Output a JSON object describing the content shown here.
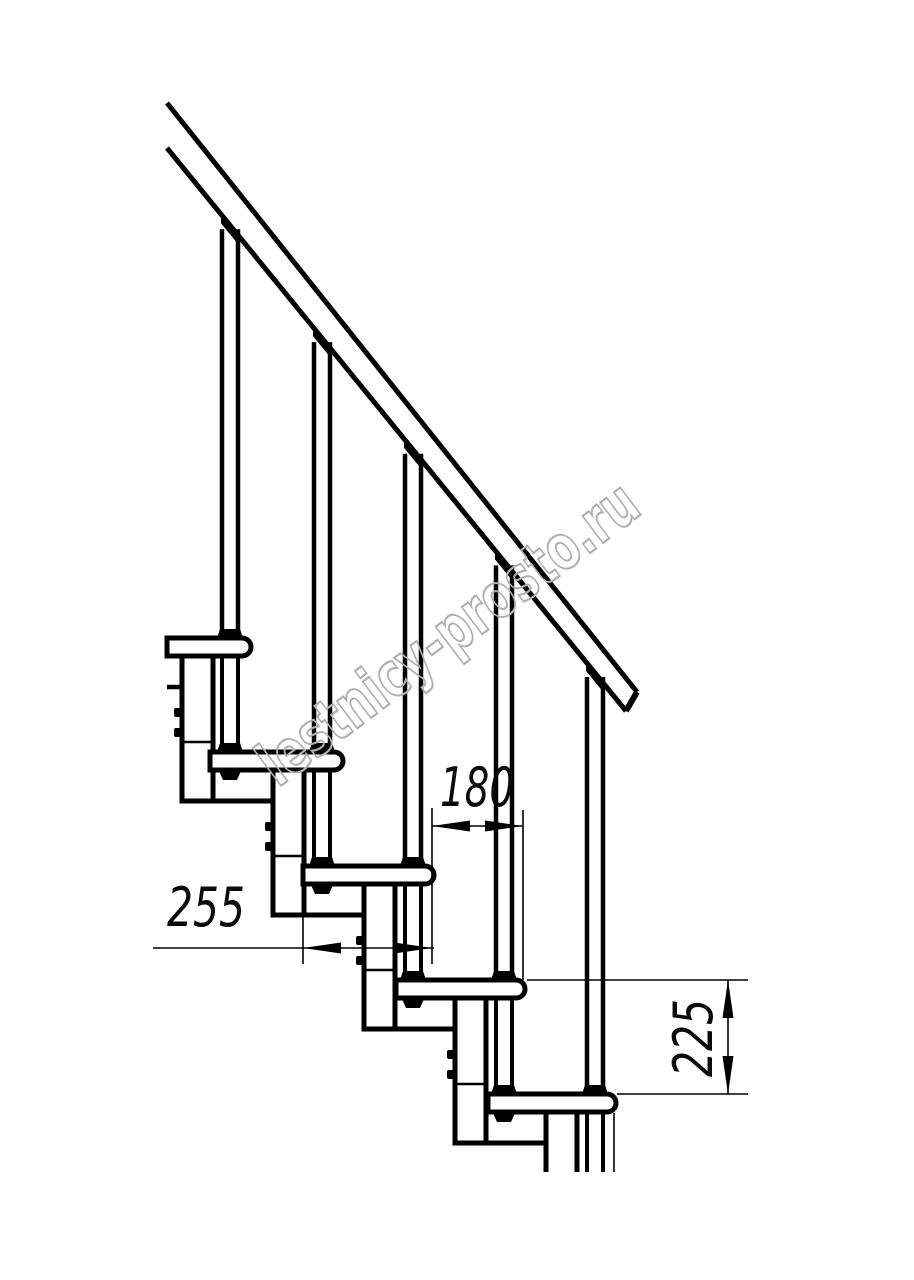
{
  "drawing": {
    "kind": "modular-staircase-side-view",
    "watermark": "lestnicy-prosto.ru",
    "line_color": "#000000",
    "background_color": "#ffffff",
    "watermark_color": "#b0b0b0",
    "dimensions": [
      {
        "id": "tread-depth",
        "value": "255"
      },
      {
        "id": "step-going",
        "value": "180"
      },
      {
        "id": "step-rise",
        "value": "225"
      }
    ]
  },
  "geometry": {
    "canvas": {
      "width": 914,
      "height": 1280
    },
    "rail": {
      "top_start": [
        167,
        103
      ],
      "top_end": [
        637,
        692
      ],
      "bottom_start": [
        167,
        148
      ],
      "bottom_end": [
        626,
        711
      ]
    },
    "steps": {
      "tread_tops": [
        638,
        752,
        866,
        980,
        1094
      ],
      "tread_backs": [
        167,
        210,
        303,
        396,
        488
      ],
      "tread_fronts": [
        251,
        343,
        434,
        525,
        616
      ],
      "tread_thickness": 18,
      "corner_radius": 9,
      "column_lefts": [
        182,
        273,
        364,
        455,
        546
      ],
      "column_width": 31,
      "column_depth": 163,
      "column_joint_offset": 104,
      "bolt_y_offsets": [
        70,
        90
      ],
      "baluster_inset": 21,
      "baluster_half_width": 8,
      "cut_bottom": 1172,
      "stub_plate": {
        "y": 687,
        "x1": 167,
        "x2": 184
      }
    },
    "dims": {
      "d255": {
        "line_y": 948,
        "line_x_start": 153,
        "x1": 303,
        "x2": 432
      },
      "d180": {
        "line_y": 826,
        "x1": 432,
        "x2": 523
      },
      "d225": {
        "line_x": 728,
        "y1": 980,
        "y2": 1094
      },
      "ext_lines": [
        [
          303,
          886,
          303,
          964
        ],
        [
          432,
          808,
          432,
          964
        ],
        [
          523,
          810,
          523,
          980
        ],
        [
          527,
          980,
          748,
          980
        ],
        [
          617,
          1094,
          748,
          1094
        ]
      ],
      "front_ref_line": [
        614,
        1113,
        614,
        1172
      ],
      "arrow": {
        "length": 38,
        "half_width": 5.5
      }
    },
    "style": {
      "thick": 5,
      "cap": 6,
      "wall": 4.5,
      "joint": 2.5,
      "thin": 1.6
    }
  }
}
